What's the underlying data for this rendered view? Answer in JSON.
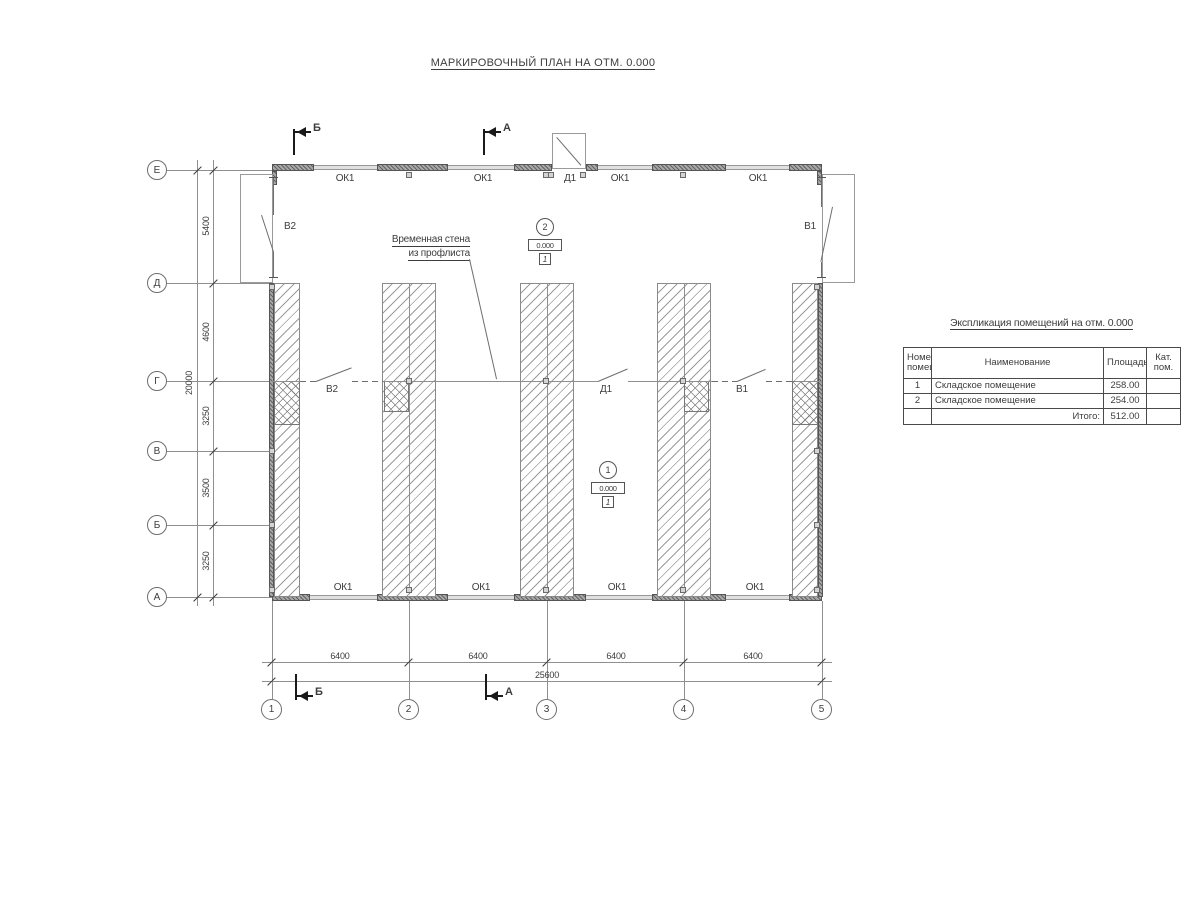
{
  "title": "МАРКИРОВОЧНЫЙ ПЛАН НА ОТМ. 0.000",
  "colors": {
    "line_gray": "#8f8f8f",
    "wall_dark": "#555555",
    "text": "#3d3d3d"
  },
  "plan": {
    "left_axes": [
      "Е",
      "Д",
      "Г",
      "В",
      "Б",
      "А"
    ],
    "bottom_axes": [
      "1",
      "2",
      "3",
      "4",
      "5"
    ],
    "dims_left": [
      "5400",
      "4600",
      "3250",
      "3500",
      "3250"
    ],
    "dim_left_total": "20000",
    "dims_bottom": [
      "6400",
      "6400",
      "6400",
      "6400"
    ],
    "dim_bottom_total": "25600",
    "top_openings": [
      "ОК1",
      "ОК1",
      "Д1",
      "ОК1",
      "ОК1"
    ],
    "bottom_openings": [
      "ОК1",
      "ОК1",
      "ОК1",
      "ОК1"
    ],
    "gate_left": "В2",
    "gate_right": "В1",
    "partition": {
      "left": "В2",
      "door": "Д1",
      "right": "В1"
    },
    "note1": "Временная стена",
    "note2": "из профлиста",
    "sec_top_1": "Б",
    "sec_top_2": "А",
    "sec_bot_1": "Б",
    "sec_bot_2": "А",
    "rooms": [
      {
        "num": "2",
        "elev": "0.000",
        "floor": "1"
      },
      {
        "num": "1",
        "elev": "0.000",
        "floor": "1"
      }
    ]
  },
  "table": {
    "title": "Экспликация помещений на отм. 0.000",
    "headers": [
      "Номер помещ.",
      "Наименование",
      "Площадь",
      "Кат. пом."
    ],
    "rows": [
      {
        "num": "1",
        "name": "Складское помещение",
        "area": "258.00",
        "cat": ""
      },
      {
        "num": "2",
        "name": "Складское помещение",
        "area": "254.00",
        "cat": ""
      }
    ],
    "total_label": "Итого:",
    "total_value": "512.00"
  }
}
